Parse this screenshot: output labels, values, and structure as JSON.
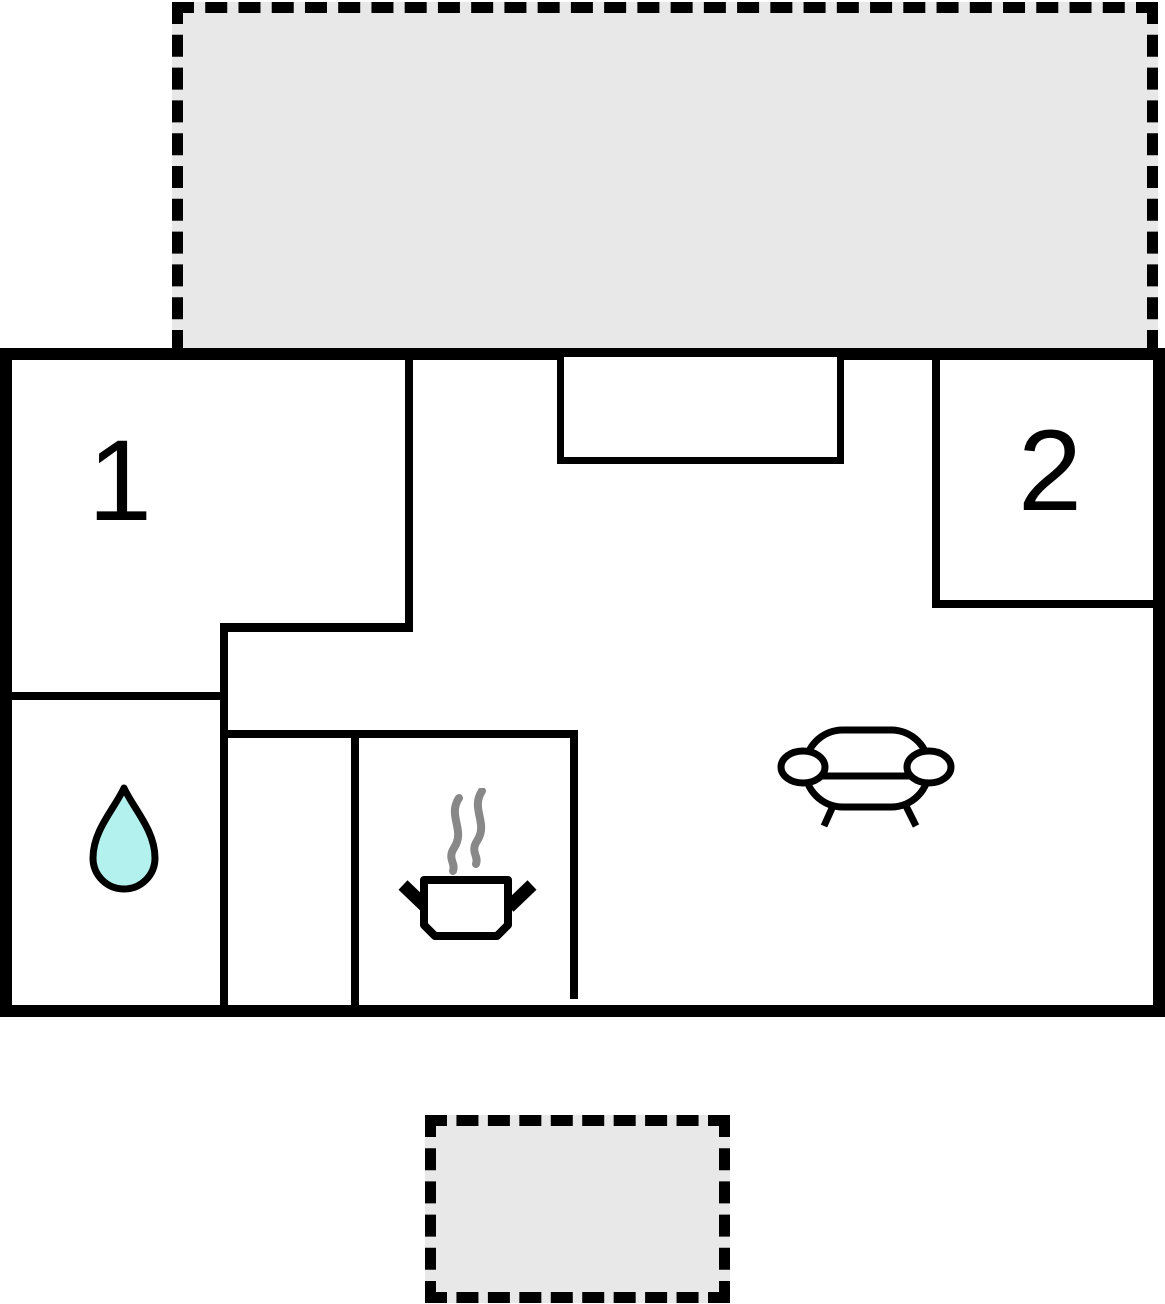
{
  "title": "studio-apartment-floor-plan",
  "rooms": [
    {
      "label": "1",
      "name": "bedroom-1"
    },
    {
      "label": "2",
      "name": "bedroom-2"
    }
  ],
  "areas": {
    "terrace_top": "terrace",
    "terrace_bottom": "terrace",
    "bathroom_icon": "water-drop",
    "kitchen_icon": "cooking-pot-with-steam",
    "living_icon": "sofa"
  },
  "colors": {
    "wall": "#000000",
    "terrace_fill": "#e8e8e8",
    "interior": "#ffffff",
    "background": "#ffffff",
    "drop_fill": "#b3f1ef",
    "steam": "#888888"
  }
}
